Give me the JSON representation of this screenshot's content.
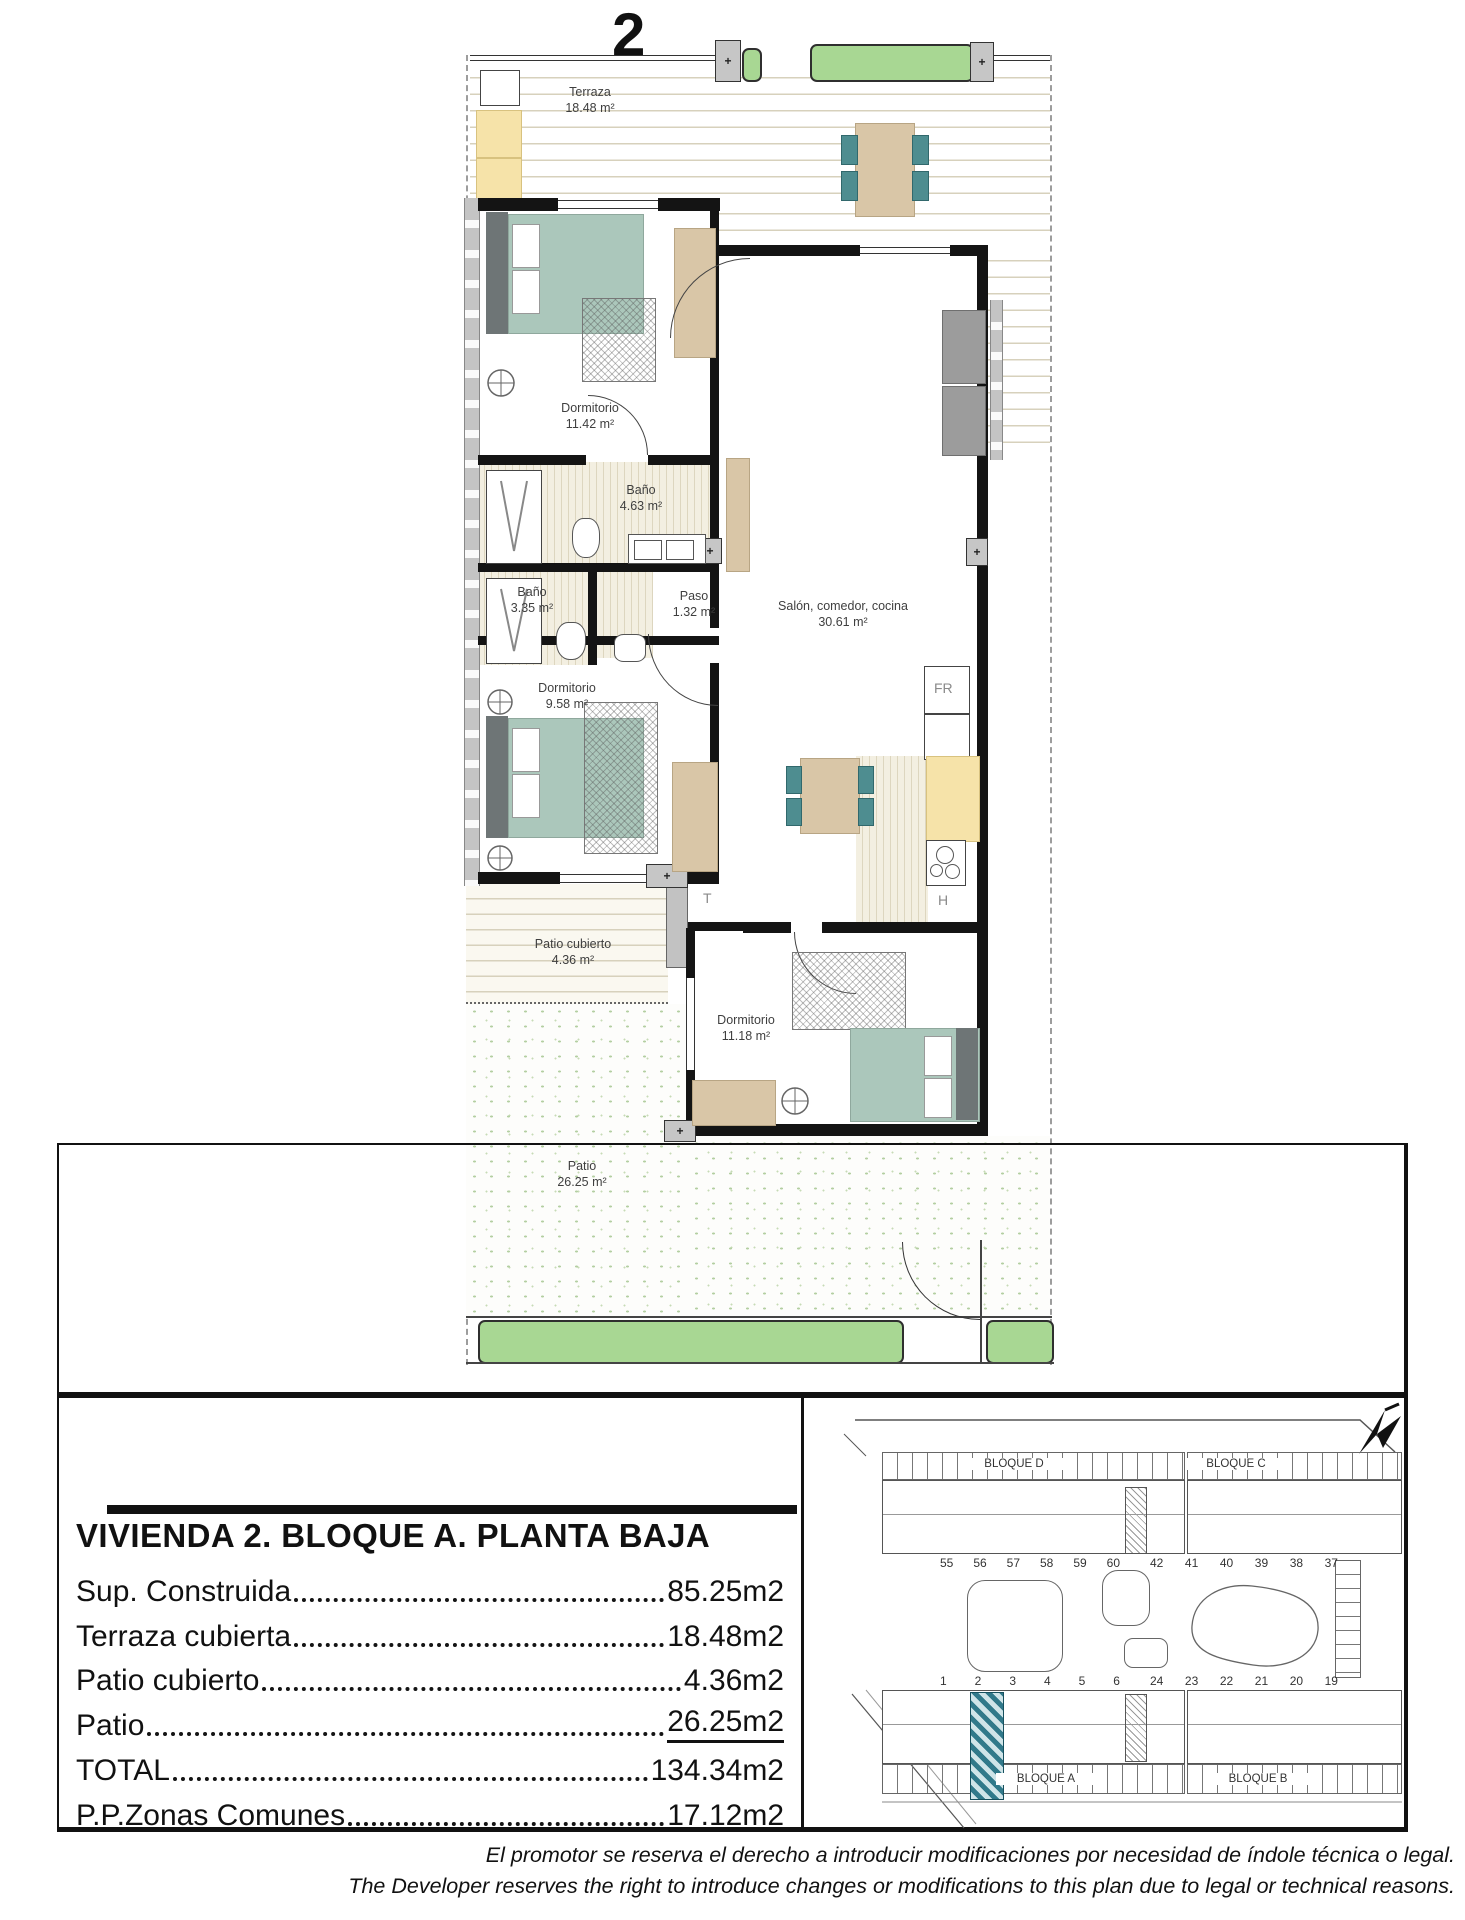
{
  "page": {
    "unit_number": "2"
  },
  "plan": {
    "terraza": {
      "name": "Terraza",
      "area": "18.48 m²"
    },
    "dorm1": {
      "name": "Dormitorio",
      "area": "11.42 m²"
    },
    "bano1": {
      "name": "Baño",
      "area": "4.63 m²"
    },
    "bano2": {
      "name": "Baño",
      "area": "3.35 m²"
    },
    "paso": {
      "name": "Paso",
      "area": "1.32 m²"
    },
    "salon": {
      "name": "Salón, comedor, cocina",
      "area": "30.61 m²"
    },
    "dorm2": {
      "name": "Dormitorio",
      "area": "9.58 m²"
    },
    "patio_cubierto": {
      "name": "Patio cubierto",
      "area": "4.36 m²"
    },
    "dorm3": {
      "name": "Dormitorio",
      "area": "11.18 m²"
    },
    "patio": {
      "name": "Patio",
      "area": "26.25 m²"
    },
    "labels": {
      "fridge": "FR",
      "hob": "H",
      "tap": "T"
    },
    "plus": "+"
  },
  "info": {
    "title": "VIVIENDA 2. BLOQUE A. PLANTA BAJA",
    "rows": [
      {
        "label": "Sup. Construida",
        "value": "85.25m2"
      },
      {
        "label": "Terraza cubierta",
        "value": "18.48m2"
      },
      {
        "label": "Patio cubierto",
        "value": "4.36m2"
      },
      {
        "label": "Patio",
        "value": "26.25m2"
      },
      {
        "label": "TOTAL",
        "value": "134.34m2"
      },
      {
        "label": "P.P.Zonas Comunes",
        "value": "17.12m2"
      }
    ]
  },
  "site": {
    "bloque_d": "BLOQUE D",
    "bloque_c": "BLOQUE C",
    "bloque_a": "BLOQUE A",
    "bloque_b": "BLOQUE B",
    "row_top_left": [
      "55",
      "56",
      "57",
      "58",
      "59",
      "60"
    ],
    "row_top_right": [
      "42",
      "41",
      "40",
      "39",
      "38",
      "37"
    ],
    "row_bottom_left": [
      "1",
      "2",
      "3",
      "4",
      "5",
      "6"
    ],
    "row_bottom_right": [
      "24",
      "23",
      "22",
      "21",
      "20",
      "19"
    ],
    "highlighted_unit": "2"
  },
  "footer": {
    "es": "El promotor se reserva el derecho a introducir modificaciones por necesidad de índole técnica o legal.",
    "en": "The Developer reserves the right to introduce changes or modifications to this plan due to legal or technical reasons."
  },
  "colors": {
    "teal": "#4e8d90",
    "bed": "#abc7bb",
    "tan": "#d9c6a7",
    "counter": "#f6e3a9",
    "hedge": "#a8d793",
    "wall": "#141414",
    "highlight": "#31798a"
  }
}
